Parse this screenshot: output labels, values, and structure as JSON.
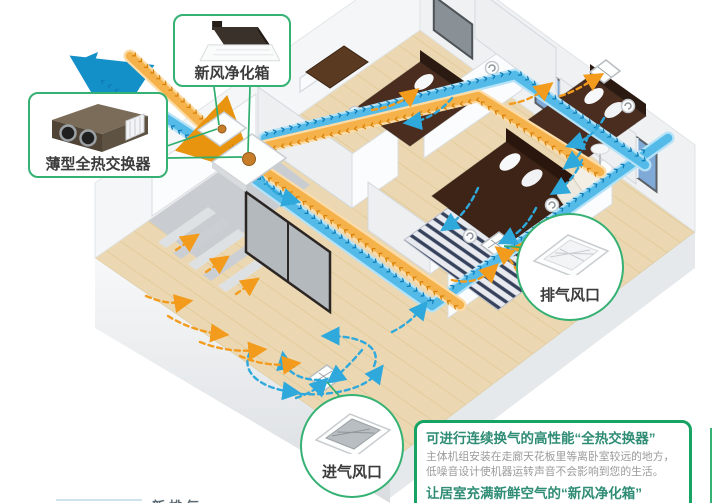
{
  "callouts": {
    "fresh_air_box": {
      "label": "新风净化箱"
    },
    "heat_exchanger": {
      "label": "薄型全热交换器"
    },
    "exhaust_vent": {
      "label": "排气风口"
    },
    "intake_vent": {
      "label": "进气风口"
    }
  },
  "info_box": {
    "heading_1": "可进行连续换气的高性能“全热交换器”",
    "body_line_1": "主体机组安装在走廊天花板里等离卧室较远的地方，",
    "body_line_2": "低噪音设计使机器运转声音不会影响到您的生活。",
    "heading_2": "让居室充满新鲜空气的“新风净化箱”"
  },
  "legend_fragment": "新排气",
  "colors": {
    "supply_air_blue": "#2BA6DB",
    "return_air_orange": "#F5A623",
    "callout_green": "#35B173",
    "info_border_green": "#17A363",
    "heading_teal": "#2F8C75"
  },
  "diagram": {
    "type": "isometric-floorplan",
    "subject": "whole-house fresh-air ventilation system with total heat exchanger",
    "chevrons": "››››››››››››››››››››››››››››››››››››››››››››››››››››››››››››",
    "airflows": [
      {
        "color": "blue",
        "meaning": "fresh/supply air ducts and room airflow"
      },
      {
        "color": "orange",
        "meaning": "return/exhaust airflow toward vents"
      }
    ],
    "components": [
      "fresh-air-purifier-unit",
      "thin-total-heat-exchanger",
      "ceiling-exhaust-vent",
      "ceiling-intake-vent",
      "ceiling-fan-symbols"
    ]
  }
}
